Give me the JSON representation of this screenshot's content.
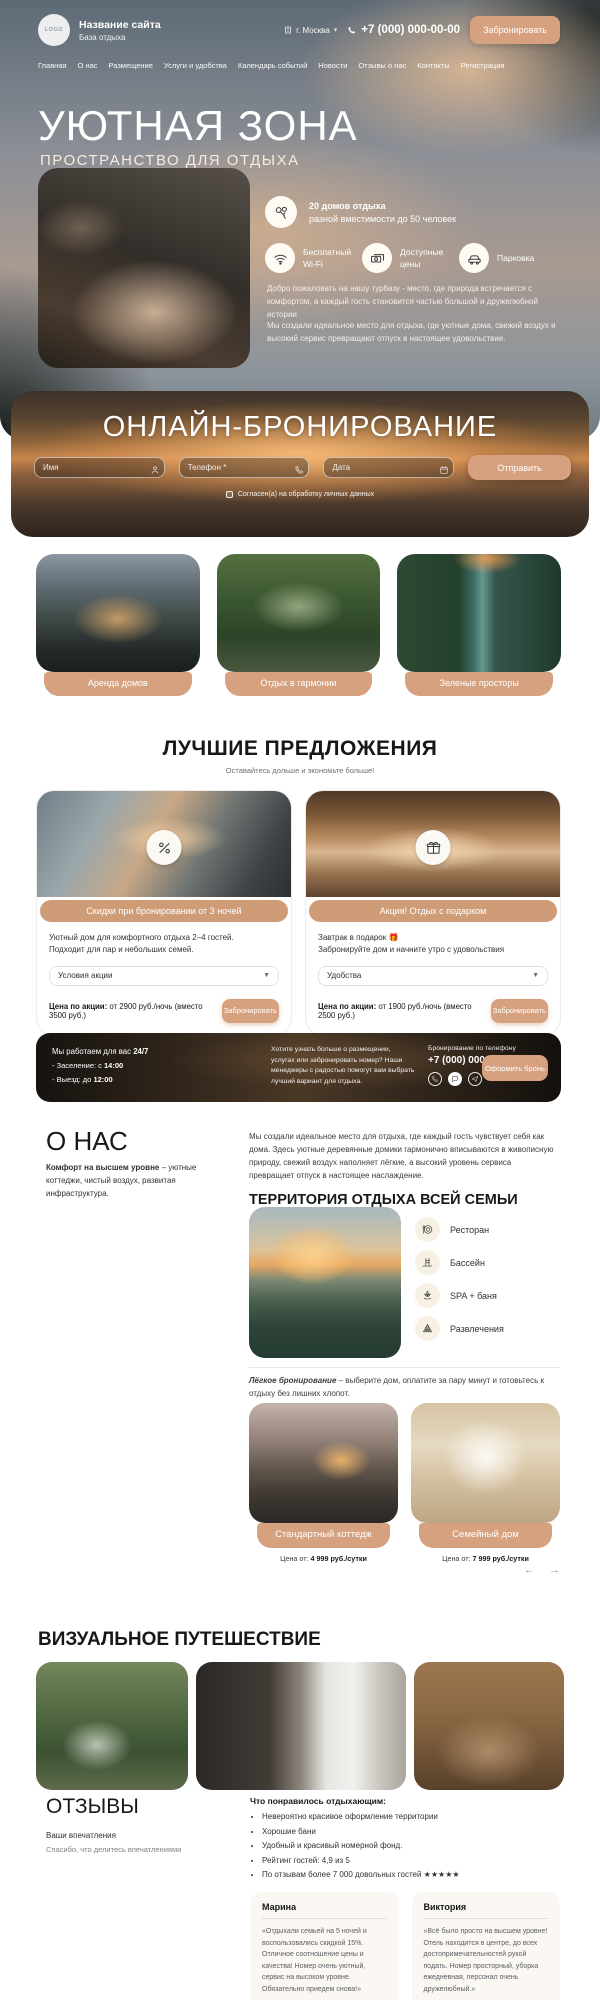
{
  "header": {
    "logo_text": "LOGO",
    "site_name": "Название сайта",
    "site_tagline": "База отдыха",
    "city": "г. Москва",
    "phone": "+7 (000) 000-00-00",
    "book_button": "Забронировать"
  },
  "nav": {
    "items": [
      "Главная",
      "О нас",
      "Размещение",
      "Услуги и удобства",
      "Календарь событий",
      "Новости",
      "Отзывы о нас",
      "Контакты",
      "Регистрация"
    ]
  },
  "hero": {
    "title": "УЮТНАЯ ЗОНА",
    "subtitle": "ПРОСТРАНСТВО ДЛЯ ОТДЫХА",
    "features": [
      {
        "line1": "20 домов отдыха",
        "line2": "разной вместимости до 50 человек"
      },
      {
        "label": "Бесплатный Wi-Fi"
      },
      {
        "label": "Доступные цены"
      },
      {
        "label": "Парковка"
      }
    ],
    "paragraph1": "Добро пожаловать на нашу турбазу - место, где природа встречается с комфортом, а каждый гость становится частью большой и дружелюбной истории",
    "paragraph2": "Мы создали идеальное место для отдыха, где уютные дома, свежий воздух и высокий сервис превращают отпуск в настоящее удовольствие."
  },
  "booking": {
    "title": "ОНЛАЙН-БРОНИРОВАНИЕ",
    "name_placeholder": "Имя",
    "phone_placeholder": "Телефон *",
    "date_placeholder": "Дата",
    "submit_button": "Отправить",
    "consent": "Согласен(а) на обработку личных данных"
  },
  "highlight_cards": [
    {
      "label": "Аренда домов"
    },
    {
      "label": "Отдых в гармонии"
    },
    {
      "label": "Зеленые просторы"
    }
  ],
  "offers": {
    "title": "ЛУЧШИЕ ПРЕДЛОЖЕНИЯ",
    "subtitle": "Оставайтесь дольше и экономьте больше!",
    "cards": [
      {
        "badge": "Скидки при бронировании от 3 ночей",
        "line1": "Уютный дом для комфортного отдыха 2–4 гостей.",
        "line2": "Подходит для пар и небольших семей.",
        "select": "Условия акции",
        "price_label": "Цена по акции:",
        "price_value": " от 2900 руб./ночь (вместо 3500 руб.)",
        "button": "Забронировать"
      },
      {
        "badge": "Акция! Отдых с подарком",
        "line1": "Завтрак в подарок 🎁",
        "line2": "Забронируйте дом и начните утро с удовольствия",
        "select": "Удобства",
        "price_label": "Цена по акции:",
        "price_value": " от 1900 руб./ночь (вместо 2500 руб.)",
        "button": "Забронировать"
      }
    ]
  },
  "banner": {
    "hours_prefix": "Мы работаем для вас ",
    "hours_bold": "24/7",
    "checkin_prefix": "- Заселение:  с ",
    "checkin_bold": "14:00",
    "checkout_prefix": "- Выезд:  до ",
    "checkout_bold": "12:00",
    "text": "Хотите узнать больше о размещении, услугах или забронировать номер? Наши менеджеры с радостью помогут вам выбрать лучший вариант для отдыха.",
    "phone_label": "Бронирование по телефону",
    "phone": "+7 (000) 000-00-00",
    "button": "Оформить бронь"
  },
  "about": {
    "title": "О НАС",
    "lead_bold": "Комфорт на высшем уровне",
    "lead_rest": " – уютные коттеджи, чистый воздух, развитая инфраструктура.",
    "paragraph": "Мы создали идеальное место для отдыха, где каждый гость чувствует себя как дома. Здесь уютные деревянные домики гармонично вписываются в живописную природу, свежий воздух наполняет лёгкие, а высокий уровень сервиса превращает отпуск в настоящее наслаждение."
  },
  "territory": {
    "title": "ТЕРРИТОРИЯ ОТДЫХА ВСЕЙ СЕМЬИ",
    "amenities": [
      {
        "label": "Ресторан"
      },
      {
        "label": "Бассейн"
      },
      {
        "label": "SPA + баня"
      },
      {
        "label": "Развлечения"
      }
    ],
    "easy_bold": "Лёгкое бронирование",
    "easy_rest": " – выберите дом, оплатите за пару минут и готовьтесь к отдыху без лишних хлопот."
  },
  "houses": {
    "cards": [
      {
        "label": "Стандартный коттедж",
        "price_label": "Цена от: ",
        "price_value": "4 999 руб./сутки"
      },
      {
        "label": "Семейный дом",
        "price_label": "Цена от: ",
        "price_value": "7 999 руб./сутки"
      }
    ],
    "prev": "←",
    "next": "→"
  },
  "gallery": {
    "title": "ВИЗУАЛЬНОЕ ПУТЕШЕСТВИЕ"
  },
  "reviews": {
    "title": "ОТЗЫВЫ",
    "subtitle1": "Ваши впечатления",
    "subtitle2": "Спасибо, что делитесь впечатлениями",
    "liked_title": "Что понравилось отдыхающим:",
    "liked_items": [
      "Невероятно красивое оформление территории",
      "Хорошие бани",
      "Удобный и красивый номерной фонд.",
      "Рейтинг гостей: 4,9 из 5",
      "По отзывам более 7 000 довольных гостей ★★★★★"
    ],
    "cards": [
      {
        "name": "Марина",
        "text": "«Отдыхали семьей на 5 ночей и воспользовались скидкой 15%. Отличное соотношение цены и качества! Номер очень уютный, сервис на высоком уровне. Обязательно приедем снова!»"
      },
      {
        "name": "Виктория",
        "text": "«Всё было просто на высшем уровне! Отель находится в центре, до всех достопримечательностей рукой подать. Номер просторный, уборка ежедневная, персонал очень дружелюбный.»"
      }
    ]
  },
  "colors": {
    "accent": "#D6A17E",
    "badge": "#CF9C78",
    "dark_text": "#17181a"
  }
}
